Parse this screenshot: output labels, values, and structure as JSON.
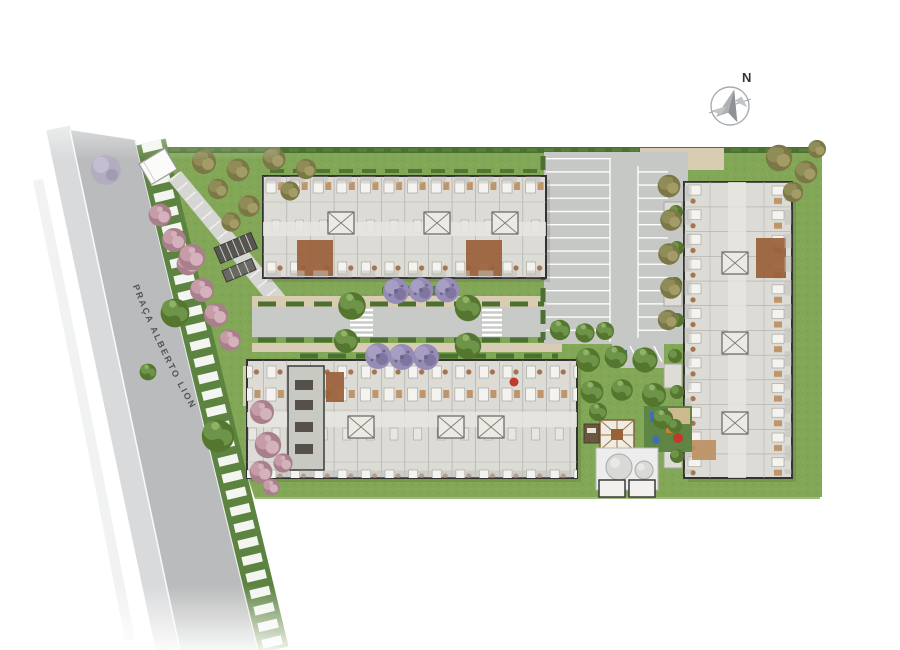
{
  "street": {
    "label": "PRAÇA ALBERTO LION"
  },
  "compass": {
    "north_label": "N"
  },
  "colors": {
    "grass": "#82a756",
    "grass_light": "#92b264",
    "hedge": "#4c7032",
    "verge": "#5d8340",
    "road": "#b9bbbc",
    "road_light": "#d9dadb",
    "internal_road": "#c8cac7",
    "parking": "#c6c8c6",
    "stall_line": "#ffffff",
    "building_fill": "#dcdbd5",
    "building_wall": "#333333",
    "corridor": "#e6e5df",
    "deck_brown": "#9a6038",
    "wood_light": "#bc8f60",
    "tree_green": "#6d9448",
    "tree_green_dark": "#55762f",
    "tree_green_light": "#8fb266",
    "tree_olive": "#8f8c58",
    "tree_olive_light": "#a39c66",
    "tree_olive_dark": "#7b7747",
    "tree_pink": "#c59ca8",
    "tree_pink_light": "#d4b2bb",
    "tree_pink_dark": "#a97f8b",
    "tree_purple": "#968cb6",
    "tree_purple_light": "#a79ec4",
    "tree_purple_dark": "#7f759e",
    "tan_paving": "#d8cdb2",
    "walkway": "#d6d7d4",
    "label_gray": "#54555a",
    "compass_gray": "#a7abae",
    "access_blue": "#3f6fae",
    "play_red": "#c0392b",
    "play_orange": "#d07f2e",
    "play_green": "#5f8544",
    "tank_gray": "#d9dad8"
  }
}
